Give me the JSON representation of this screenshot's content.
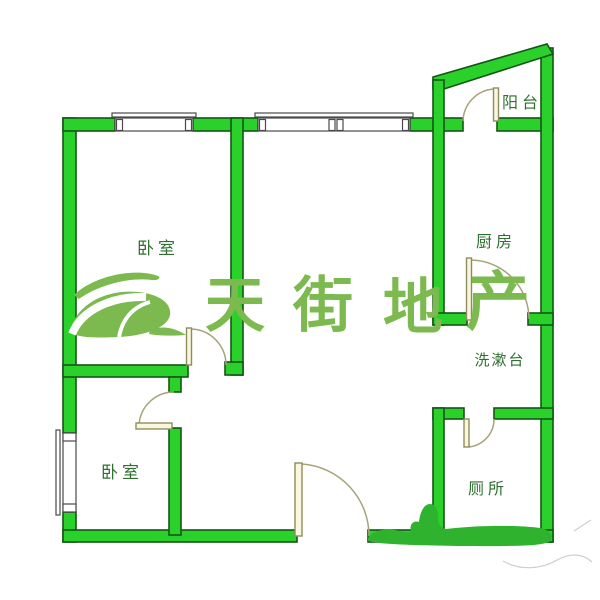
{
  "colors": {
    "background": "#ffffff",
    "wall_fill": "#2bd12b",
    "wall_outline": "#155515",
    "handdrawn_green": "#2fb32f",
    "door_leaf_fill": "#faf6df",
    "door_leaf_outline": "#8f8d5e",
    "door_arc": "#a6a379",
    "window_outline": "#4a4a4a",
    "label_text": "#2f7030",
    "watermark_green": "#7cba4f"
  },
  "rooms": [
    {
      "name": "bedroom-top",
      "label": "卧室"
    },
    {
      "name": "balcony",
      "label": "阳台"
    },
    {
      "name": "kitchen",
      "label": "厨房"
    },
    {
      "name": "washstand",
      "label": "洗漱台"
    },
    {
      "name": "bedroom-bottom",
      "label": "卧室"
    },
    {
      "name": "toilet",
      "label": "厕所"
    }
  ],
  "watermark": {
    "brand_name": "天街地产",
    "brand_chars": [
      "天",
      "街",
      "地",
      "产"
    ],
    "logo": "tianjie-swoosh-leaf-logo"
  }
}
